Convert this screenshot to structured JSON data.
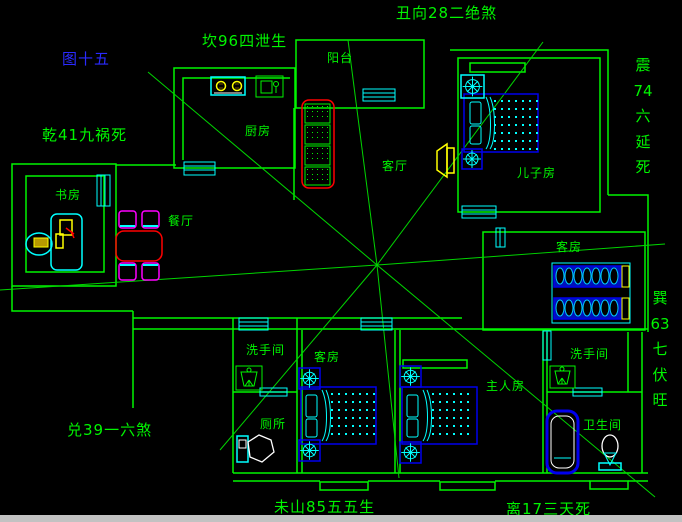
{
  "title": "图十五",
  "colors": {
    "background": "#000000",
    "wall_green": "#00F500",
    "fixture_cyan": "#00FFFF",
    "bed_blue": "#0000EE",
    "accent_red": "#FF0000",
    "accent_yellow": "#FFFF00",
    "chair_magenta": "#FF00FF",
    "title_blue": "#2A2AFF",
    "window_edge_grey": "#C2C2C2"
  },
  "fengshui_annotations": [
    {
      "id": "figure-number",
      "text": "图十五",
      "x": 62,
      "y": 50
    },
    {
      "id": "north-kan",
      "text": "坎96四泄生",
      "x": 202,
      "y": 32
    },
    {
      "id": "top-chou",
      "text": "丑向28二绝煞",
      "x": 396,
      "y": 4
    },
    {
      "id": "west-qian",
      "text": "乾41九祸死",
      "x": 42,
      "y": 126
    },
    {
      "id": "southwest-dui",
      "text": "兑39一六煞",
      "x": 67,
      "y": 421
    },
    {
      "id": "bottom-wei",
      "text": "未山85五五生",
      "x": 274,
      "y": 498
    },
    {
      "id": "bottom-li",
      "text": "离17三天死",
      "x": 506,
      "y": 500
    }
  ],
  "vertical_annotations": [
    {
      "id": "east-zhen",
      "chars": [
        "震",
        "74",
        "六",
        "延",
        "死"
      ],
      "x": 631,
      "y": 55
    },
    {
      "id": "southeast-xun",
      "chars": [
        "巽",
        "63",
        "七",
        "伏",
        "旺"
      ],
      "x": 648,
      "y": 288
    }
  ],
  "room_labels": [
    {
      "id": "balcony",
      "text": "阳台",
      "x": 327,
      "y": 51
    },
    {
      "id": "kitchen",
      "text": "厨房",
      "x": 245,
      "y": 124
    },
    {
      "id": "living-room",
      "text": "客厅",
      "x": 382,
      "y": 159
    },
    {
      "id": "dining-room",
      "text": "餐厅",
      "x": 168,
      "y": 214
    },
    {
      "id": "study",
      "text": "书房",
      "x": 55,
      "y": 188
    },
    {
      "id": "sons-room",
      "text": "儿子房",
      "x": 517,
      "y": 166
    },
    {
      "id": "guest-room-east",
      "text": "客房",
      "x": 556,
      "y": 240
    },
    {
      "id": "guest-room-south",
      "text": "客房",
      "x": 314,
      "y": 350
    },
    {
      "id": "washroom-west",
      "text": "洗手间",
      "x": 246,
      "y": 343
    },
    {
      "id": "toilet-west",
      "text": "厕所",
      "x": 260,
      "y": 417
    },
    {
      "id": "master-room",
      "text": "主人房",
      "x": 486,
      "y": 379
    },
    {
      "id": "washroom-east",
      "text": "洗手间",
      "x": 570,
      "y": 347
    },
    {
      "id": "bathroom-east",
      "text": "卫生间",
      "x": 583,
      "y": 418
    }
  ]
}
